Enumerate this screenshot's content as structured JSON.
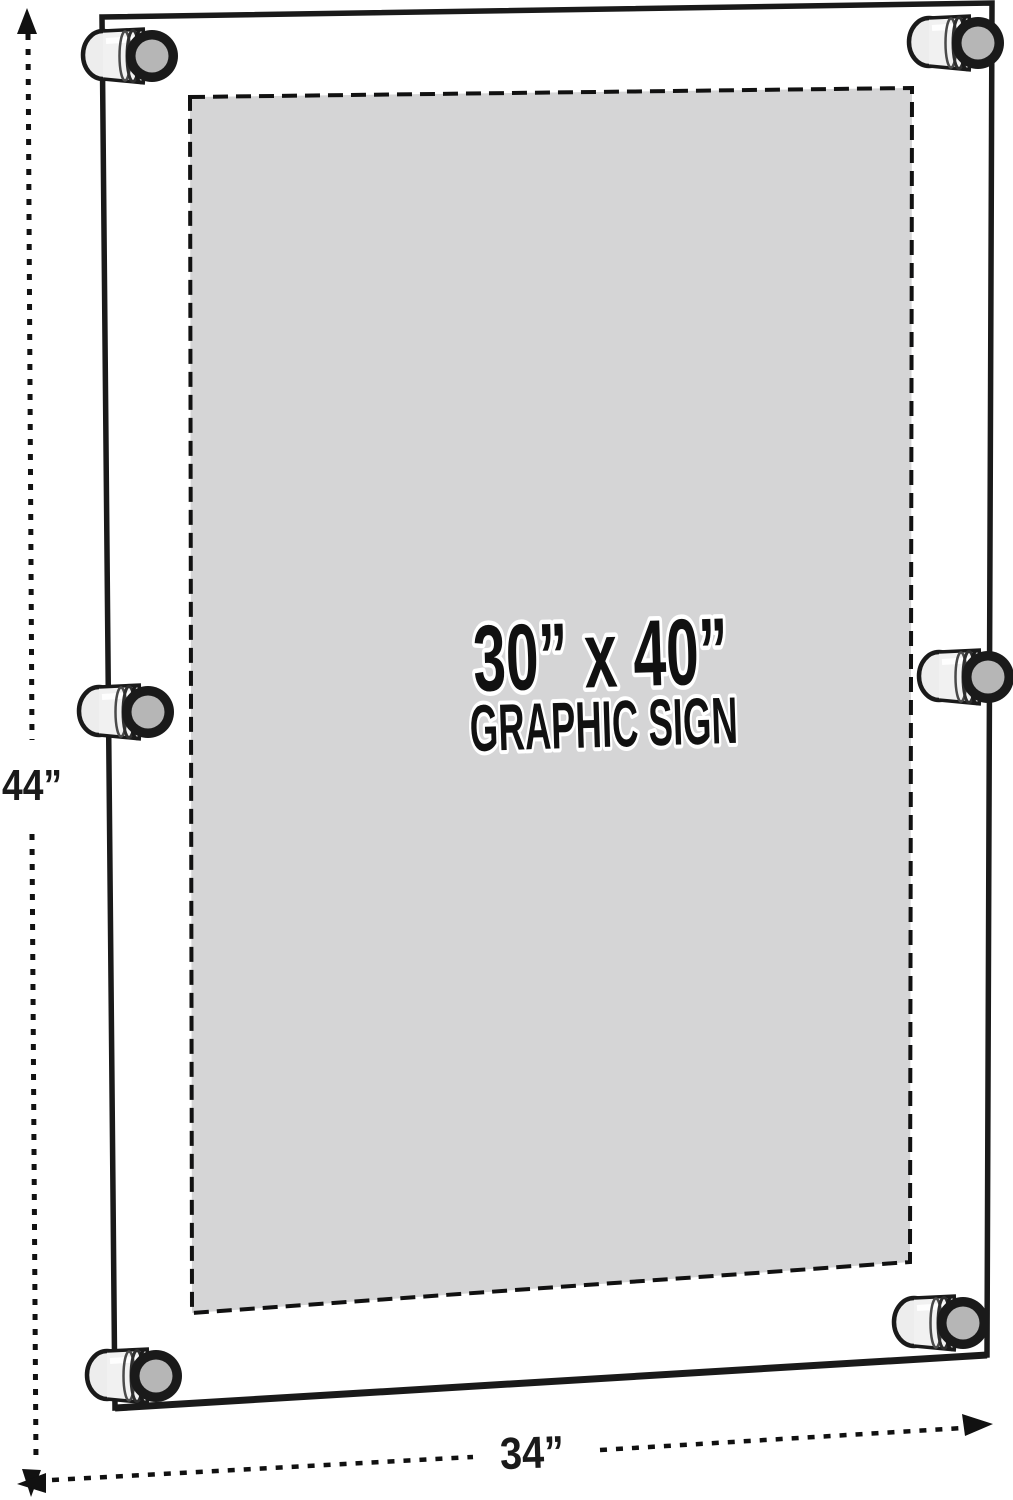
{
  "scene": {
    "background_color": "#ffffff",
    "line_color": "#1a1a1a"
  },
  "sign_panel": {
    "size_label": "30” x 40”",
    "caption": "GRAPHIC SIGN",
    "fill_color": "#d5d5d6",
    "border_style": "dashed"
  },
  "frame": {
    "standoff_count": 6,
    "standoff_cap_color": "#b6b6b6",
    "standoff_body_color": "#f1f1f1"
  },
  "dimension_annotations": {
    "height_label": "44”",
    "width_label": "34”"
  }
}
